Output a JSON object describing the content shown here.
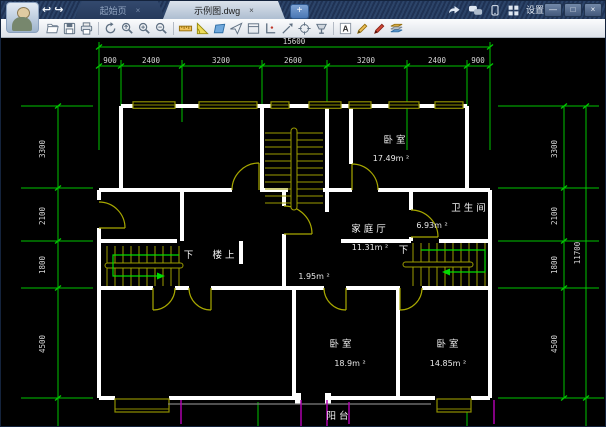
{
  "chrome": {
    "tabs": [
      {
        "label": "起始页",
        "close": "×"
      },
      {
        "label": "示例图.dwg",
        "close": "×"
      }
    ],
    "new_tab": "+",
    "settings_label": "设置",
    "window_buttons": {
      "minimize": "—",
      "maximize": "□",
      "close": "×"
    }
  },
  "toolbar": {
    "text_tool_glyph": "A"
  },
  "plan": {
    "dims": {
      "top_total": "15600",
      "top_segments": [
        "900",
        "2400",
        "3200",
        "2600",
        "3200",
        "2400",
        "900"
      ],
      "left_segments": [
        "3300",
        "2100",
        "1800",
        "4500"
      ],
      "right_segments": [
        "3300",
        "2100",
        "1800",
        "4500"
      ],
      "right_total": "11700"
    },
    "rooms": {
      "bedroom_top": {
        "name": "卧室",
        "area": "17.49m ²"
      },
      "family_hall": {
        "name": "家庭厅",
        "area": "11.31m ²"
      },
      "bathroom": {
        "name": "卫生间",
        "area": "6.93m ²"
      },
      "hall_area": "1.95m ²",
      "stair_down_left": "下",
      "stair_up_left": "楼上",
      "stair_down_right": "下",
      "bedroom_left": {
        "name": "卧室",
        "area": "18.9m ²"
      },
      "bedroom_right": {
        "name": "卧室",
        "area": "14.85m ²"
      },
      "balcony": "阳台"
    }
  },
  "colors": {
    "axis_green": "#00c400",
    "path_green": "#00dc00",
    "wall_white": "#ffffff",
    "window_olive": "#8f8f00",
    "stair_yellow": "#9c9c00",
    "balcony_magenta": "#b800b8",
    "dim_text": "#d6d6d6",
    "canvas_bg": "#000000"
  }
}
